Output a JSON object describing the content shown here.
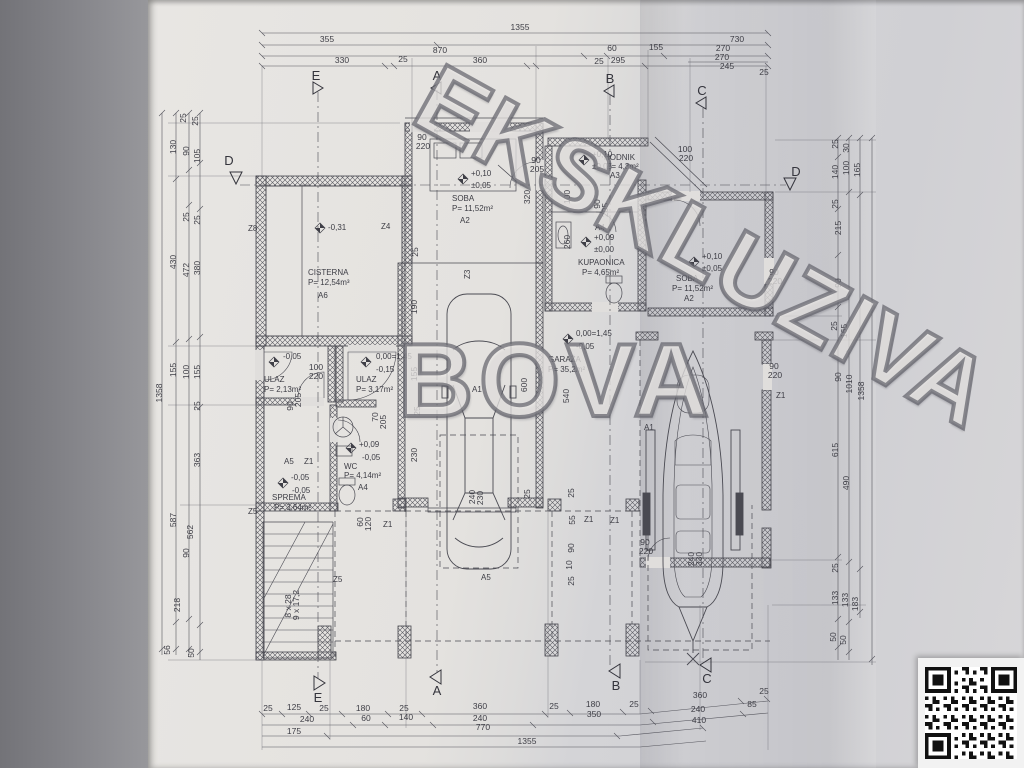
{
  "watermark": {
    "diagonal": "EKSKLUZIVA",
    "horizontal": "BOVA"
  },
  "markers": {
    "top": [
      "E",
      "A",
      "B",
      "C"
    ],
    "bottom": [
      "E",
      "A",
      "B",
      "C"
    ],
    "left_d": "D",
    "right_d": "D"
  },
  "dims": {
    "top": [
      "1355",
      "355",
      "730",
      "870",
      "60",
      "155",
      "270",
      "330",
      "25",
      "360",
      "25",
      "295",
      "270",
      "245",
      "25"
    ],
    "bottom": [
      "25",
      "125",
      "25",
      "180",
      "25",
      "360",
      "25",
      "180",
      "25",
      "360",
      "25",
      "85",
      "240",
      "60",
      "140",
      "240",
      "350",
      "240",
      "410",
      "175",
      "770",
      "1355"
    ],
    "left": [
      "25",
      "25",
      "130",
      "90",
      "105",
      "25",
      "25",
      "430",
      "472",
      "380",
      "155",
      "100",
      "155",
      "25",
      "363",
      "587",
      "562",
      "90",
      "218",
      "56",
      "50",
      "1358"
    ],
    "right": [
      "25",
      "30",
      "140",
      "100",
      "165",
      "25",
      "215",
      "90",
      "25",
      "165",
      "90",
      "1010",
      "1358",
      "615",
      "490",
      "25",
      "133",
      "133",
      "183",
      "50",
      "50"
    ],
    "inner": [
      "90",
      "220",
      "90",
      "205",
      "320",
      "25",
      "100",
      "220",
      "90",
      "205",
      "100",
      "260",
      "190",
      "90",
      "220",
      "100",
      "220",
      "90",
      "205",
      "70",
      "205",
      "155",
      "25",
      "230",
      "600",
      "540",
      "60",
      "120",
      "240",
      "230",
      "25",
      "25",
      "55",
      "90",
      "10",
      "25",
      "90",
      "220",
      "90",
      "220",
      "240",
      "330",
      "8 x 28",
      "9 x 17,2"
    ]
  },
  "codes": [
    "Z8",
    "Z4",
    "Z1",
    "A5",
    "Z5",
    "Z5",
    "Z1",
    "Z1",
    "Z1",
    "Z1",
    "Z3"
  ],
  "rooms": {
    "cisterna": {
      "name": "CISTERNA",
      "area": "P= 12,54m³",
      "code": "A6",
      "level": "-0,31"
    },
    "soba_left": {
      "name": "SOBA",
      "area": "P= 11,52m²",
      "code": "A2",
      "level1": "+0,10",
      "level2": "±0,05"
    },
    "hodnik": {
      "name": "HODNIK",
      "area": "P= 4,3m²",
      "code": "A3",
      "level1": "+0,10",
      "level2": "±0,05"
    },
    "kupaonica": {
      "name": "KUPAONICA",
      "area": "P= 4,65m²",
      "code": "A4",
      "level1": "+0,09",
      "level2": "±0,00"
    },
    "soba_right": {
      "name": "SOBA",
      "area": "P= 11,52m²",
      "code": "A2",
      "level1": "+0,10",
      "level2": "±0,05"
    },
    "garaza": {
      "name": "GARAŽA",
      "area": "P= 35,2m²",
      "code": "A1",
      "level1": "0,00=1,45",
      "level2": "-0,05"
    },
    "ulaz_left": {
      "name": "ULAZ",
      "area": "P= 2,13m²",
      "level": "-0,05"
    },
    "ulaz_right": {
      "name": "ULAZ",
      "area": "P= 3,17m²",
      "level1": "0,00=1,45",
      "level2": "-0,15"
    },
    "wc": {
      "name": "WC",
      "area": "P= 4,14m²",
      "code": "A4",
      "level1": "+0,09",
      "level2": "-0,05"
    },
    "sprema": {
      "name": "SPREMA",
      "area": "P= 3,64m²",
      "code": "A5",
      "level1": "-0,05",
      "level2": "-0,05"
    },
    "terasa": {
      "code": "A5"
    },
    "boat_garage": {
      "code": "A1"
    }
  }
}
